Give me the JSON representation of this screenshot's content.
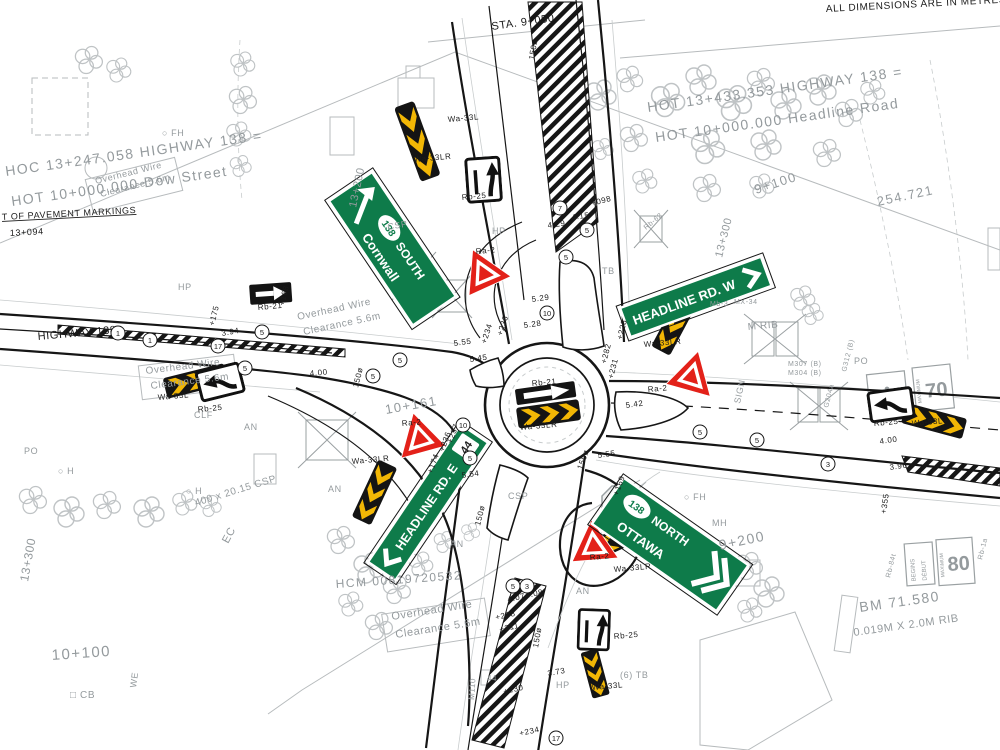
{
  "drawing_title": "Roundabout intersection plan - Highway 138 at Headline Road / Dow Street",
  "colors": {
    "sign_green": "#0e7b4a",
    "chevron_yellow": "#f2b705",
    "yield_red": "#e32119",
    "cad_grey": "#949a9d",
    "line_black": "#161616"
  },
  "signs": {
    "cornwall": {
      "route": "138",
      "direction": "SOUTH",
      "city": "Cornwall"
    },
    "headline_w": {
      "text": "HEADLINE RD. W"
    },
    "headline_e": {
      "text": "HEADLINE RD. E",
      "shield": "44"
    },
    "ottawa": {
      "route": "138",
      "direction": "NORTH",
      "city": "OTTAWA"
    },
    "stop": "STOP",
    "max70": {
      "legend": "MAXIMUM",
      "value": "70"
    },
    "max80": {
      "legend": "MAXIMUM",
      "value": "80",
      "begins": "BEGINS",
      "debut": "DÉBUT"
    }
  },
  "labels": [
    {
      "t": "ALL DIMENSIONS ARE IN METRES",
      "x": 826,
      "y": 12,
      "r": -3,
      "s": 10,
      "c": "k"
    },
    {
      "t": "STA. 9+050",
      "x": 492,
      "y": 30,
      "r": -8,
      "s": 11,
      "c": "k"
    },
    {
      "t": "HOC 13+247.058 HIGHWAY 138 =",
      "x": 6,
      "y": 176,
      "r": -8,
      "s": 14,
      "c": "g big"
    },
    {
      "t": "HOT 10+000.000 Dow Street",
      "x": 12,
      "y": 206,
      "r": -8,
      "s": 14,
      "c": "g big"
    },
    {
      "t": "T OF PAVEMENT MARKINGS",
      "x": 2,
      "y": 220,
      "r": -3,
      "s": 9,
      "c": "k",
      "u": 1
    },
    {
      "t": "13+094",
      "x": 10,
      "y": 236,
      "r": -3,
      "s": 9,
      "c": "k"
    },
    {
      "t": "13+200",
      "x": 356,
      "y": 208,
      "r": -78,
      "s": 11,
      "c": "g"
    },
    {
      "t": "HOT 13+433.353 HIGHWAY 138 =",
      "x": 648,
      "y": 112,
      "r": -8,
      "s": 14,
      "c": "g big"
    },
    {
      "t": "HOT 10+000.000 Headline Road",
      "x": 656,
      "y": 142,
      "r": -8,
      "s": 14,
      "c": "g big"
    },
    {
      "t": "9+100",
      "x": 756,
      "y": 194,
      "r": -18,
      "s": 13,
      "c": "g big"
    },
    {
      "t": "13+300",
      "x": 722,
      "y": 258,
      "r": -76,
      "s": 11,
      "c": "g"
    },
    {
      "t": "254.721",
      "x": 878,
      "y": 206,
      "r": -12,
      "s": 13,
      "c": "g big"
    },
    {
      "t": "HIGHWAY 138",
      "x": 38,
      "y": 340,
      "r": -5,
      "s": 11,
      "c": "k"
    },
    {
      "t": "Overhead Wire",
      "x": 96,
      "y": 184,
      "r": -14,
      "s": 9,
      "c": "g"
    },
    {
      "t": "Clearance 5.6m",
      "x": 101,
      "y": 197,
      "r": -14,
      "s": 9,
      "c": "g"
    },
    {
      "t": "Overhead Wire",
      "x": 298,
      "y": 320,
      "r": -12,
      "s": 10,
      "c": "g"
    },
    {
      "t": "Clearance 5.6m",
      "x": 304,
      "y": 335,
      "r": -12,
      "s": 10,
      "c": "g"
    },
    {
      "t": "Overhead Wire",
      "x": 146,
      "y": 374,
      "r": -7,
      "s": 10,
      "c": "g"
    },
    {
      "t": "Clearance 5.6m",
      "x": 151,
      "y": 389,
      "r": -7,
      "s": 10,
      "c": "g"
    },
    {
      "t": "Overhead Wire",
      "x": 392,
      "y": 620,
      "r": -9,
      "s": 11,
      "c": "g"
    },
    {
      "t": "Clearance 5.6m",
      "x": 396,
      "y": 638,
      "r": -9,
      "s": 11,
      "c": "g"
    },
    {
      "t": "HCM 00819720532",
      "x": 336,
      "y": 588,
      "r": -4,
      "s": 12,
      "c": "g big"
    },
    {
      "t": "BM 71.580",
      "x": 860,
      "y": 612,
      "r": -8,
      "s": 14,
      "c": "g big"
    },
    {
      "t": "0.019M X 2.0M RIB",
      "x": 854,
      "y": 636,
      "r": -8,
      "s": 11,
      "c": "g"
    },
    {
      "t": "10+100",
      "x": 52,
      "y": 660,
      "r": -4,
      "s": 15,
      "c": "g big"
    },
    {
      "t": "WE",
      "x": 136,
      "y": 688,
      "r": -82,
      "s": 9,
      "c": "g"
    },
    {
      "t": "□ CB",
      "x": 70,
      "y": 698,
      "r": 0,
      "s": 10,
      "c": "g"
    },
    {
      "t": "13+300",
      "x": 28,
      "y": 582,
      "r": -80,
      "s": 12,
      "c": "g"
    },
    {
      "t": "EC",
      "x": 228,
      "y": 544,
      "r": -62,
      "s": 11,
      "c": "g"
    },
    {
      "t": "400 x 20.15 CSP",
      "x": 196,
      "y": 506,
      "r": -17,
      "s": 10,
      "c": "g"
    },
    {
      "t": "10+161",
      "x": 386,
      "y": 414,
      "r": -10,
      "s": 13,
      "c": "g big"
    },
    {
      "t": "9+200",
      "x": 720,
      "y": 550,
      "r": -12,
      "s": 14,
      "c": "g big"
    },
    {
      "t": "○ FH",
      "x": 162,
      "y": 136,
      "r": 0,
      "s": 9,
      "c": "g"
    },
    {
      "t": "○ FH",
      "x": 684,
      "y": 500,
      "r": 0,
      "s": 9,
      "c": "g"
    },
    {
      "t": "MH",
      "x": 712,
      "y": 526,
      "r": 0,
      "s": 9,
      "c": "g"
    },
    {
      "t": "HP",
      "x": 178,
      "y": 290,
      "r": 0,
      "s": 9,
      "c": "g"
    },
    {
      "t": "HP",
      "x": 492,
      "y": 234,
      "r": 0,
      "s": 9,
      "c": "g"
    },
    {
      "t": "HP",
      "x": 556,
      "y": 688,
      "r": 0,
      "s": 9,
      "c": "g"
    },
    {
      "t": "PO",
      "x": 24,
      "y": 454,
      "r": 0,
      "s": 9,
      "c": "g"
    },
    {
      "t": "PO",
      "x": 854,
      "y": 364,
      "r": 0,
      "s": 9,
      "c": "g"
    },
    {
      "t": "AN",
      "x": 244,
      "y": 430,
      "r": 0,
      "s": 9,
      "c": "g"
    },
    {
      "t": "AN",
      "x": 328,
      "y": 492,
      "r": 0,
      "s": 9,
      "c": "g"
    },
    {
      "t": "AN",
      "x": 450,
      "y": 547,
      "r": 0,
      "s": 9,
      "c": "g"
    },
    {
      "t": "AN",
      "x": 576,
      "y": 594,
      "r": 0,
      "s": 9,
      "c": "g"
    },
    {
      "t": "CLF",
      "x": 194,
      "y": 418,
      "r": 0,
      "s": 9,
      "c": "g"
    },
    {
      "t": "TB",
      "x": 602,
      "y": 274,
      "r": 0,
      "s": 9,
      "c": "g"
    },
    {
      "t": "(6) TB",
      "x": 620,
      "y": 678,
      "r": 0,
      "s": 9,
      "c": "g"
    },
    {
      "t": "○ H",
      "x": 58,
      "y": 474,
      "r": 0,
      "s": 9,
      "c": "g"
    },
    {
      "t": "○ H",
      "x": 186,
      "y": 494,
      "r": 0,
      "s": 9,
      "c": "g"
    },
    {
      "t": "CSP",
      "x": 388,
      "y": 230,
      "r": -10,
      "s": 9,
      "c": "g"
    },
    {
      "t": "CSP",
      "x": 508,
      "y": 499,
      "r": 0,
      "s": 9,
      "c": "g"
    },
    {
      "t": "Wa-33L",
      "x": 448,
      "y": 122,
      "r": -5,
      "s": 8,
      "c": "k"
    },
    {
      "t": "Wa-33LR",
      "x": 414,
      "y": 162,
      "r": -5,
      "s": 8,
      "c": "k"
    },
    {
      "t": "Rb-25",
      "x": 462,
      "y": 200,
      "r": -5,
      "s": 8,
      "c": "k"
    },
    {
      "t": "Ra-2",
      "x": 476,
      "y": 254,
      "r": -5,
      "s": 8,
      "c": "k"
    },
    {
      "t": "Rb-21",
      "x": 258,
      "y": 310,
      "r": -5,
      "s": 8,
      "c": "k"
    },
    {
      "t": "Rb-21",
      "x": 532,
      "y": 386,
      "r": -5,
      "s": 8,
      "c": "k"
    },
    {
      "t": "Wa-33LR",
      "x": 520,
      "y": 430,
      "r": -5,
      "s": 8,
      "c": "k"
    },
    {
      "t": "Wa-33LR",
      "x": 644,
      "y": 347,
      "r": -5,
      "s": 8,
      "c": "k"
    },
    {
      "t": "Ra-2",
      "x": 648,
      "y": 392,
      "r": -5,
      "s": 8,
      "c": "k"
    },
    {
      "t": "Ra-2",
      "x": 402,
      "y": 426,
      "r": -5,
      "s": 8,
      "c": "k"
    },
    {
      "t": "Wa-33LR",
      "x": 352,
      "y": 464,
      "r": -5,
      "s": 8,
      "c": "k"
    },
    {
      "t": "Ra-2",
      "x": 590,
      "y": 560,
      "r": -5,
      "s": 8,
      "c": "k"
    },
    {
      "t": "Wa-33LR",
      "x": 614,
      "y": 572,
      "r": -5,
      "s": 8,
      "c": "k"
    },
    {
      "t": "Wa-33L",
      "x": 158,
      "y": 400,
      "r": -5,
      "s": 8,
      "c": "k"
    },
    {
      "t": "Rb-25",
      "x": 198,
      "y": 412,
      "r": -5,
      "s": 8,
      "c": "k"
    },
    {
      "t": "Rb-25",
      "x": 874,
      "y": 426,
      "r": -5,
      "s": 8,
      "c": "k"
    },
    {
      "t": "Wa-33L",
      "x": 912,
      "y": 426,
      "r": -5,
      "s": 8,
      "c": "k"
    },
    {
      "t": "Rb-25",
      "x": 614,
      "y": 639,
      "r": -5,
      "s": 8,
      "c": "k"
    },
    {
      "t": "Wa-33L",
      "x": 592,
      "y": 690,
      "r": -5,
      "s": 8,
      "c": "k"
    },
    {
      "t": "Rb-62",
      "x": 646,
      "y": 230,
      "r": -40,
      "s": 7,
      "c": "g"
    },
    {
      "t": "M307 (B)",
      "x": 788,
      "y": 366,
      "r": 0,
      "s": 7,
      "c": "g"
    },
    {
      "t": "M304 (B)",
      "x": 788,
      "y": 375,
      "r": 0,
      "s": 7,
      "c": "g"
    },
    {
      "t": "Mb-3",
      "x": 710,
      "y": 306,
      "r": 0,
      "s": 7,
      "c": "g"
    },
    {
      "t": "MX-34",
      "x": 734,
      "y": 304,
      "r": 0,
      "s": 7,
      "c": "g"
    },
    {
      "t": "G312 (B)",
      "x": 846,
      "y": 372,
      "r": -76,
      "s": 7,
      "c": "g"
    },
    {
      "t": "G204a",
      "x": 828,
      "y": 408,
      "r": -76,
      "s": 7,
      "c": "g"
    },
    {
      "t": "SIGN",
      "x": 740,
      "y": 404,
      "r": -78,
      "s": 9,
      "c": "g"
    },
    {
      "t": "M RIB",
      "x": 748,
      "y": 330,
      "r": -5,
      "s": 10,
      "c": "g"
    },
    {
      "t": "Rb-84t",
      "x": 890,
      "y": 578,
      "r": -76,
      "s": 7,
      "c": "g"
    },
    {
      "t": "Rb-1a",
      "x": 982,
      "y": 560,
      "r": -76,
      "s": 7,
      "c": "g"
    },
    {
      "t": "M110",
      "x": 474,
      "y": 700,
      "r": -86,
      "s": 8,
      "c": "g"
    },
    {
      "t": "44",
      "x": 487,
      "y": 681,
      "r": 0,
      "s": 8,
      "c": "g"
    },
    {
      "t": "3.94",
      "x": 222,
      "y": 336,
      "r": -10,
      "s": 8,
      "c": "k"
    },
    {
      "t": "+175",
      "x": 214,
      "y": 326,
      "r": -76,
      "s": 8,
      "c": "k"
    },
    {
      "t": "+168",
      "x": 284,
      "y": 306,
      "r": -76,
      "s": 8,
      "c": "k"
    },
    {
      "t": "4.00",
      "x": 310,
      "y": 376,
      "r": -5,
      "s": 8,
      "c": "k"
    },
    {
      "t": "150ø",
      "x": 358,
      "y": 388,
      "r": -76,
      "s": 8,
      "c": "k"
    },
    {
      "t": "5.55",
      "x": 454,
      "y": 346,
      "r": -8,
      "s": 8,
      "c": "k"
    },
    {
      "t": "+234",
      "x": 486,
      "y": 344,
      "r": -72,
      "s": 8,
      "c": "k"
    },
    {
      "t": "+236",
      "x": 502,
      "y": 336,
      "r": -72,
      "s": 8,
      "c": "k"
    },
    {
      "t": "5.45",
      "x": 470,
      "y": 362,
      "r": -8,
      "s": 8,
      "c": "k"
    },
    {
      "t": "5.29",
      "x": 532,
      "y": 302,
      "r": -8,
      "s": 8,
      "c": "k"
    },
    {
      "t": "5.28",
      "x": 524,
      "y": 328,
      "r": -8,
      "s": 8,
      "c": "k"
    },
    {
      "t": "4.29",
      "x": 548,
      "y": 228,
      "r": -8,
      "s": 8,
      "c": "k"
    },
    {
      "t": "4.15",
      "x": 572,
      "y": 220,
      "r": -8,
      "s": 8,
      "c": "k"
    },
    {
      "t": "+098",
      "x": 592,
      "y": 206,
      "r": -15,
      "s": 8,
      "c": "k"
    },
    {
      "t": "150ø",
      "x": 534,
      "y": 60,
      "r": -80,
      "s": 8,
      "c": "k"
    },
    {
      "t": "+228",
      "x": 622,
      "y": 340,
      "r": -76,
      "s": 8,
      "c": "k"
    },
    {
      "t": "+282",
      "x": 606,
      "y": 364,
      "r": -76,
      "s": 8,
      "c": "k"
    },
    {
      "t": "+231",
      "x": 613,
      "y": 379,
      "r": -76,
      "s": 8,
      "c": "k"
    },
    {
      "t": "5.42",
      "x": 626,
      "y": 408,
      "r": -8,
      "s": 8,
      "c": "k"
    },
    {
      "t": "5.55",
      "x": 598,
      "y": 458,
      "r": -8,
      "s": 8,
      "c": "k"
    },
    {
      "t": "+169",
      "x": 618,
      "y": 496,
      "r": -70,
      "s": 8,
      "c": "k"
    },
    {
      "t": "150ø",
      "x": 582,
      "y": 470,
      "r": -70,
      "s": 8,
      "c": "k"
    },
    {
      "t": "+174",
      "x": 432,
      "y": 474,
      "r": -70,
      "s": 8,
      "c": "k"
    },
    {
      "t": "+236",
      "x": 444,
      "y": 452,
      "r": -70,
      "s": 8,
      "c": "k"
    },
    {
      "t": "+237",
      "x": 452,
      "y": 444,
      "r": -70,
      "s": 8,
      "c": "k"
    },
    {
      "t": "5.54",
      "x": 462,
      "y": 478,
      "r": -8,
      "s": 8,
      "c": "k"
    },
    {
      "t": "150ø",
      "x": 480,
      "y": 526,
      "r": -76,
      "s": 8,
      "c": "k"
    },
    {
      "t": "3.96",
      "x": 890,
      "y": 470,
      "r": -8,
      "s": 8,
      "c": "k"
    },
    {
      "t": "+355",
      "x": 886,
      "y": 514,
      "r": -82,
      "s": 8,
      "c": "k"
    },
    {
      "t": "4.00",
      "x": 880,
      "y": 444,
      "r": -8,
      "s": 8,
      "c": "k"
    },
    {
      "t": "+208",
      "x": 496,
      "y": 620,
      "r": -12,
      "s": 8,
      "c": "k"
    },
    {
      "t": "+211",
      "x": 500,
      "y": 632,
      "r": -12,
      "s": 8,
      "c": "k"
    },
    {
      "t": "4.07",
      "x": 508,
      "y": 602,
      "r": -12,
      "s": 8,
      "c": "k"
    },
    {
      "t": "4.08",
      "x": 526,
      "y": 598,
      "r": -12,
      "s": 8,
      "c": "k"
    },
    {
      "t": "150ø",
      "x": 538,
      "y": 648,
      "r": -80,
      "s": 8,
      "c": "k"
    },
    {
      "t": "+230",
      "x": 504,
      "y": 694,
      "r": -12,
      "s": 8,
      "c": "k"
    },
    {
      "t": "3.73",
      "x": 548,
      "y": 676,
      "r": -10,
      "s": 8,
      "c": "k"
    },
    {
      "t": "+234",
      "x": 520,
      "y": 736,
      "r": -12,
      "s": 8,
      "c": "k"
    }
  ],
  "badges": [
    {
      "n": "1",
      "x": 118,
      "y": 333
    },
    {
      "n": "1",
      "x": 150,
      "y": 340
    },
    {
      "n": "17",
      "x": 218,
      "y": 346
    },
    {
      "n": "5",
      "x": 262,
      "y": 332
    },
    {
      "n": "5",
      "x": 245,
      "y": 368
    },
    {
      "n": "5",
      "x": 373,
      "y": 376
    },
    {
      "n": "5",
      "x": 400,
      "y": 360
    },
    {
      "n": "7",
      "x": 560,
      "y": 208
    },
    {
      "n": "5",
      "x": 587,
      "y": 230
    },
    {
      "n": "5",
      "x": 566,
      "y": 257
    },
    {
      "n": "10",
      "x": 547,
      "y": 313
    },
    {
      "n": "10",
      "x": 463,
      "y": 425
    },
    {
      "n": "5",
      "x": 470,
      "y": 458
    },
    {
      "n": "5",
      "x": 513,
      "y": 586
    },
    {
      "n": "3",
      "x": 527,
      "y": 586
    },
    {
      "n": "17",
      "x": 556,
      "y": 738
    },
    {
      "n": "5",
      "x": 700,
      "y": 432
    },
    {
      "n": "5",
      "x": 757,
      "y": 440
    },
    {
      "n": "3",
      "x": 828,
      "y": 464
    }
  ]
}
